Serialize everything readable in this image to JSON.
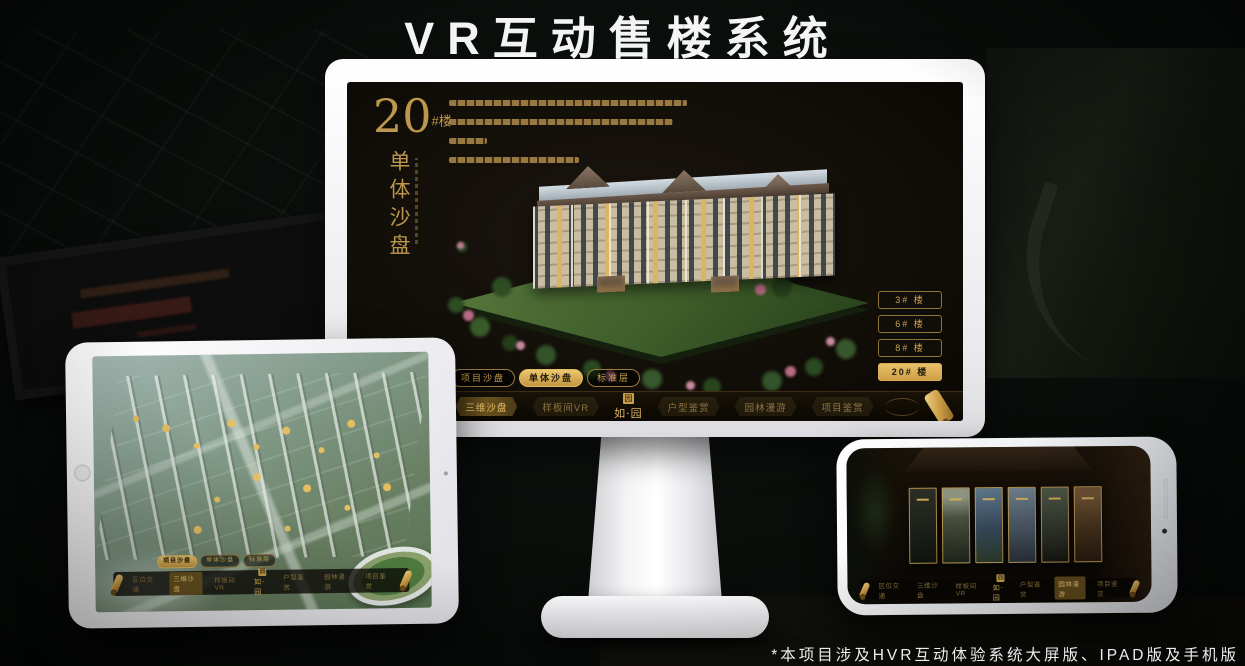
{
  "title": "VR互动售楼系统",
  "footnote": "*本项目涉及HVR互动体验系统大屏版、IPAD版及手机版",
  "brand": {
    "seal_char": "园",
    "logo_text": "如·园"
  },
  "nav_items": [
    "区位交通",
    "三维沙盘",
    "样板间VR",
    "户型鉴赏",
    "园林漫游",
    "项目鉴赏"
  ],
  "tabs": [
    "项目沙盘",
    "单体沙盘",
    "标准层"
  ],
  "monitor": {
    "headline_number": "20",
    "headline_suffix": "#楼",
    "headline_vertical": "单体沙盘",
    "floor_buttons": [
      "3# 楼",
      "6# 楼",
      "8# 楼",
      "20# 楼"
    ],
    "active_floor": "20# 楼",
    "active_tab": "单体沙盘",
    "active_nav": "三维沙盘"
  },
  "tablet": {
    "active_tab": "项目沙盘",
    "active_nav": "三维沙盘"
  },
  "phone": {
    "active_nav": "园林漫游",
    "gallery_panel_count": 6
  },
  "colors": {
    "gold": "#c9a34e",
    "gold_bright": "#e6bd60",
    "screen_bg": "#15100a",
    "background": "#070a08"
  }
}
